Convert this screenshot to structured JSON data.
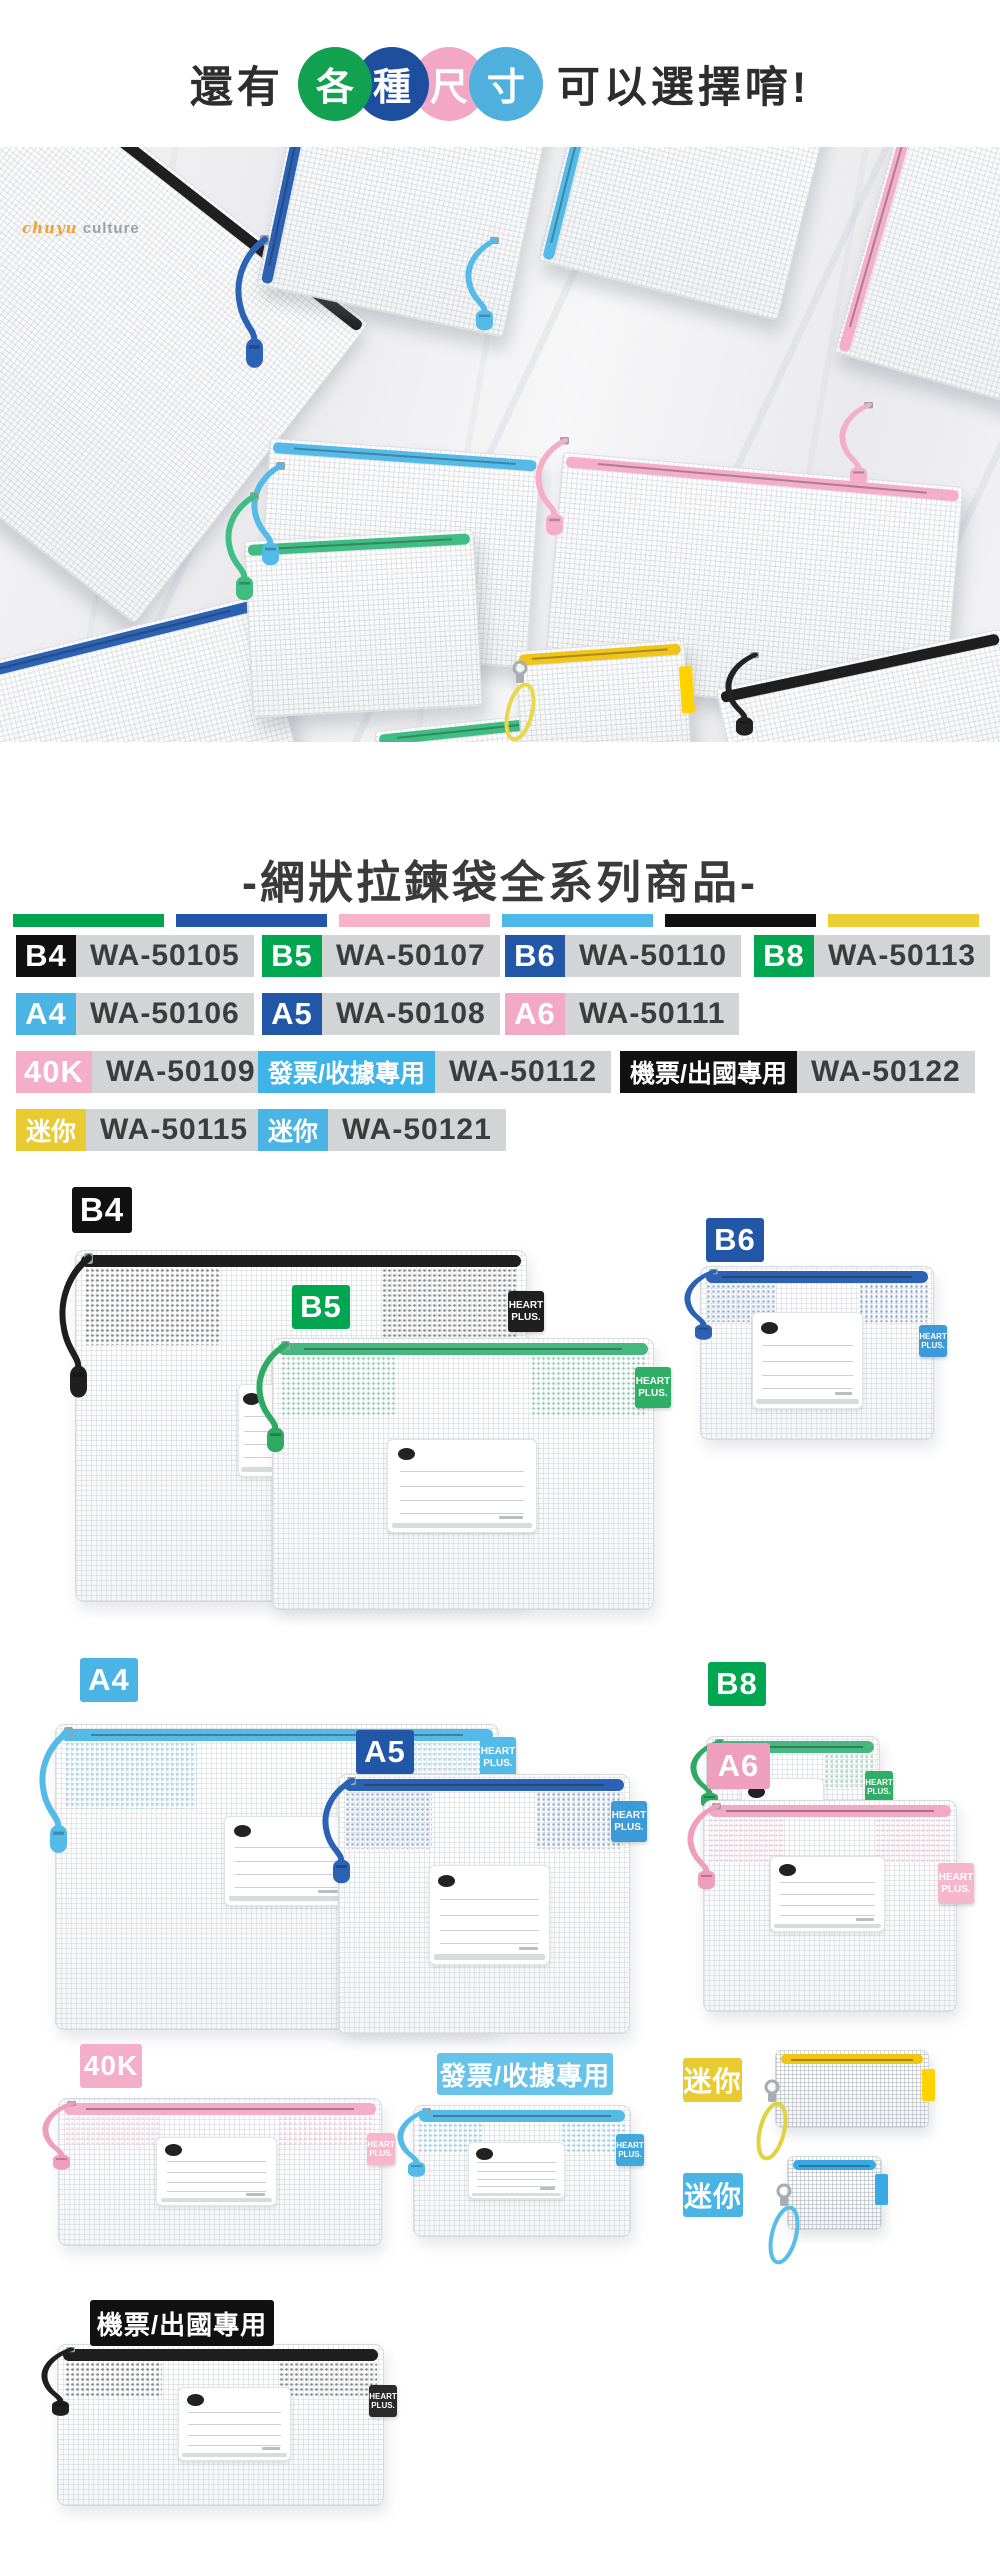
{
  "header": {
    "prefix": "還有",
    "suffix": "可以選擇唷!",
    "circles": [
      {
        "char": "各",
        "color": "#12a150",
        "z": 4
      },
      {
        "char": "種",
        "color": "#1d4f9e",
        "z": 3
      },
      {
        "char": "尺",
        "color": "#f2a8c5",
        "z": 1
      },
      {
        "char": "寸",
        "color": "#4fb0dd",
        "z": 2
      }
    ]
  },
  "photo": {
    "watermark": {
      "script": "chuyu",
      "label": "culture"
    },
    "bags": [
      {
        "x": -170,
        "y": -10,
        "w": 470,
        "h": 380,
        "r": 38,
        "zip": "#1f1f1f",
        "e": "top"
      },
      {
        "x": 872,
        "y": -70,
        "w": 290,
        "h": 320,
        "r": 16,
        "zip": "#f5aec7",
        "e": "left"
      },
      {
        "x": 278,
        "y": -70,
        "w": 250,
        "h": 235,
        "r": 12,
        "zip": "#2b62b4",
        "e": "left"
      },
      {
        "x": 560,
        "y": -70,
        "w": 245,
        "h": 215,
        "r": 14,
        "zip": "#54bae8",
        "e": "left"
      },
      {
        "x": 262,
        "y": 300,
        "w": 270,
        "h": 210,
        "r": 4,
        "zip": "#54bae8",
        "e": "top"
      },
      {
        "x": 552,
        "y": 322,
        "w": 400,
        "h": 230,
        "r": 5,
        "zip": "#f5aec7",
        "e": "top"
      },
      {
        "x": -45,
        "y": 485,
        "w": 330,
        "h": 200,
        "r": -14,
        "zip": "#2b62b4",
        "e": "top"
      },
      {
        "x": 248,
        "y": 388,
        "w": 228,
        "h": 175,
        "r": -3,
        "zip": "#3fbd82",
        "e": "top"
      },
      {
        "x": 380,
        "y": 572,
        "w": 225,
        "h": 120,
        "r": -6,
        "zip": "#3fbd82",
        "e": "top"
      },
      {
        "x": 518,
        "y": 498,
        "w": 168,
        "h": 110,
        "r": -4,
        "zip": "#f0c419",
        "e": "top",
        "tab": "#ffd200"
      },
      {
        "x": 730,
        "y": 510,
        "w": 290,
        "h": 170,
        "r": -12,
        "zip": "#1f1f1f",
        "e": "top"
      }
    ],
    "cords": [
      {
        "x": 232,
        "y": 88,
        "h": 135,
        "c": "#2b62b4"
      },
      {
        "x": 462,
        "y": 90,
        "h": 95,
        "c": "#54bae8"
      },
      {
        "x": 836,
        "y": 255,
        "h": 85,
        "c": "#f5aec7"
      },
      {
        "x": 248,
        "y": 315,
        "h": 105,
        "c": "#54bae8"
      },
      {
        "x": 532,
        "y": 290,
        "h": 100,
        "c": "#f5aec7"
      },
      {
        "x": 222,
        "y": 345,
        "h": 110,
        "c": "#3fbd82"
      },
      {
        "x": 722,
        "y": 505,
        "h": 85,
        "c": "#222222"
      },
      {
        "x": 500,
        "y": 512,
        "h": 75,
        "c": "#e8d84a",
        "strap": true
      }
    ]
  },
  "title": "-網狀拉鍊袋全系列商品-",
  "stripe": [
    "#00a34f",
    "#2356a8",
    "#f7b3c8",
    "#4cb9e8",
    "#111111",
    "#eccf35"
  ],
  "tag_lines": [
    "HEART",
    "PLUS."
  ],
  "codes": {
    "rows": [
      {
        "y": 935,
        "items": [
          {
            "x": 16,
            "label": "B4",
            "bg": "#111111",
            "code": "WA-50105"
          },
          {
            "x": 262,
            "label": "B5",
            "bg": "#00a650",
            "code": "WA-50107"
          },
          {
            "x": 505,
            "label": "B6",
            "bg": "#2257a8",
            "code": "WA-50110"
          },
          {
            "x": 754,
            "label": "B8",
            "bg": "#00a650",
            "code": "WA-50113"
          }
        ]
      },
      {
        "y": 993,
        "items": [
          {
            "x": 16,
            "label": "A4",
            "bg": "#4ab5e4",
            "code": "WA-50106"
          },
          {
            "x": 262,
            "label": "A5",
            "bg": "#2257a8",
            "code": "WA-50108"
          },
          {
            "x": 505,
            "label": "A6",
            "bg": "#f3a9c4",
            "code": "WA-50111"
          }
        ]
      },
      {
        "y": 1051,
        "items": [
          {
            "x": 16,
            "label": "40K",
            "bg": "#f5aec7",
            "code": "WA-50109"
          },
          {
            "x": 258,
            "label": "發票/收據專用",
            "bg": "#3eb4e8",
            "code": "WA-50112",
            "cjk": true
          },
          {
            "x": 620,
            "label": "機票/出國專用",
            "bg": "#111111",
            "code": "WA-50122",
            "cjk": true
          }
        ]
      },
      {
        "y": 1109,
        "items": [
          {
            "x": 16,
            "label": "迷你",
            "bg": "#e7cb31",
            "code": "WA-50115",
            "cjk": true
          },
          {
            "x": 258,
            "label": "迷你",
            "bg": "#4ab5e4",
            "code": "WA-50121",
            "cjk": true
          }
        ]
      }
    ]
  },
  "products": [
    {
      "id": "b4",
      "label": {
        "text": "B4",
        "x": 72,
        "y": 1187,
        "w": 60,
        "h": 46,
        "bg": "#111111",
        "fs": 33
      },
      "bag": {
        "x": 75,
        "y": 1250,
        "w": 450,
        "h": 350,
        "zip": "#1f1f1f",
        "cord": "#1f1f1f",
        "tag": "#1f1f1f",
        "tagY": 40,
        "card": {
          "x": 0.36,
          "y": 0.38,
          "w": 0.13,
          "h": 0.26
        },
        "z": 1
      }
    },
    {
      "id": "b5",
      "label": {
        "text": "B5",
        "x": 292,
        "y": 1285,
        "w": 58,
        "h": 44,
        "bg": "#00a650",
        "fs": 31
      },
      "bag": {
        "x": 272,
        "y": 1338,
        "w": 380,
        "h": 270,
        "zip": "#45b87f",
        "cord": "#2eaa63",
        "tag": "#2fae66",
        "tagY": 28,
        "card": {
          "x": 0.3,
          "y": 0.37,
          "w": 0.39,
          "h": 0.34
        },
        "z": 2
      }
    },
    {
      "id": "b6",
      "label": {
        "text": "B6",
        "x": 706,
        "y": 1218,
        "w": 58,
        "h": 44,
        "bg": "#2257a8",
        "fs": 31
      },
      "bag": {
        "x": 700,
        "y": 1266,
        "w": 232,
        "h": 172,
        "zip": "#2b62b4",
        "cord": "#2b62b4",
        "tag": "#3d9ad8",
        "tagY": 58,
        "card": {
          "x": 0.22,
          "y": 0.26,
          "w": 0.47,
          "h": 0.55
        },
        "z": 1
      }
    },
    {
      "id": "b8",
      "label": {
        "text": "B8",
        "x": 708,
        "y": 1662,
        "w": 58,
        "h": 44,
        "bg": "#00a650",
        "fs": 31
      },
      "bag": {
        "x": 706,
        "y": 1736,
        "w": 172,
        "h": 148,
        "zip": "#45b87f",
        "cord": "#2eaa63",
        "tag": "#2fae66",
        "tagY": 34,
        "card": {
          "x": 0.2,
          "y": 0.28,
          "w": 0.47,
          "h": 0.5
        },
        "z": 1
      }
    },
    {
      "id": "a4",
      "label": {
        "text": "A4",
        "x": 80,
        "y": 1658,
        "w": 58,
        "h": 44,
        "bg": "#4ab5e4",
        "fs": 31
      },
      "bag": {
        "x": 55,
        "y": 1724,
        "w": 442,
        "h": 304,
        "zip": "#54bae8",
        "cord": "#54bae8",
        "tag": "#54bae8",
        "tagY": 12,
        "card": {
          "x": 0.38,
          "y": 0.3,
          "w": 0.28,
          "h": 0.29
        },
        "z": 1
      }
    },
    {
      "id": "a5",
      "label": {
        "text": "A5",
        "x": 356,
        "y": 1730,
        "w": 58,
        "h": 44,
        "bg": "#2257a8",
        "fs": 31
      },
      "bag": {
        "x": 338,
        "y": 1774,
        "w": 290,
        "h": 258,
        "zip": "#2b62b4",
        "cord": "#2b62b4",
        "tag": "#3d9ad8",
        "tagY": 26,
        "card": {
          "x": 0.31,
          "y": 0.35,
          "w": 0.41,
          "h": 0.38
        },
        "z": 2
      }
    },
    {
      "id": "a6",
      "label": {
        "text": "A6",
        "x": 707,
        "y": 1743,
        "w": 63,
        "h": 46,
        "bg": "#ee9fbb",
        "fs": 31
      },
      "bag": {
        "x": 703,
        "y": 1800,
        "w": 252,
        "h": 210,
        "zip": "#f3a9c4",
        "cord": "#ef9ebc",
        "tag": "#f6b7cc",
        "tagY": 62,
        "card": {
          "x": 0.26,
          "y": 0.26,
          "w": 0.45,
          "h": 0.35
        },
        "z": 1
      }
    },
    {
      "id": "40k",
      "label": {
        "text": "40K",
        "x": 80,
        "y": 2044,
        "w": 62,
        "h": 44,
        "bg": "#f5aec7",
        "fs": 28
      },
      "bag": {
        "x": 58,
        "y": 2098,
        "w": 322,
        "h": 146,
        "zip": "#f5aec7",
        "cord": "#ef9ebc",
        "tag": "#f6b7cc",
        "tagY": 34,
        "card": {
          "x": 0.3,
          "y": 0.26,
          "w": 0.37,
          "h": 0.46
        },
        "z": 1
      }
    },
    {
      "id": "invoice",
      "label": {
        "text": "發票/收據專用",
        "x": 437,
        "y": 2053,
        "w": 176,
        "h": 42,
        "bg": "#68c3ea",
        "fs": 26
      },
      "bag": {
        "x": 413,
        "y": 2105,
        "w": 216,
        "h": 130,
        "zip": "#54bae8",
        "cord": "#54bae8",
        "tag": "#3fa9dd",
        "tagY": 28,
        "card": {
          "x": 0.25,
          "y": 0.28,
          "w": 0.44,
          "h": 0.42
        },
        "z": 1
      }
    },
    {
      "id": "mini-yellow",
      "label": {
        "text": "迷你",
        "x": 683,
        "y": 2058,
        "w": 59,
        "h": 44,
        "bg": "#e7cb31",
        "fs": 28
      },
      "pouch": {
        "x": 775,
        "y": 2050,
        "w": 152,
        "h": 76,
        "zip": "#f2c513",
        "tab": "#ffd200",
        "strap": "#dfd33f"
      }
    },
    {
      "id": "mini-blue",
      "label": {
        "text": "迷你",
        "x": 683,
        "y": 2173,
        "w": 60,
        "h": 44,
        "bg": "#4ab5e4",
        "fs": 28
      },
      "pouch": {
        "x": 787,
        "y": 2156,
        "w": 93,
        "h": 72,
        "zip": "#39a9e6",
        "tab": "#39a9e6",
        "strap": "#57bde9"
      }
    },
    {
      "id": "ticket",
      "label": {
        "text": "機票/出國專用",
        "x": 90,
        "y": 2300,
        "w": 184,
        "h": 46,
        "bg": "#111111",
        "fs": 26
      },
      "bag": {
        "x": 57,
        "y": 2344,
        "w": 325,
        "h": 160,
        "zip": "#1f1f1f",
        "cord": "#1f1f1f",
        "tag": "#2a2a2a",
        "tagY": 40,
        "card": {
          "x": 0.37,
          "y": 0.26,
          "w": 0.34,
          "h": 0.45
        },
        "z": 1
      }
    }
  ]
}
